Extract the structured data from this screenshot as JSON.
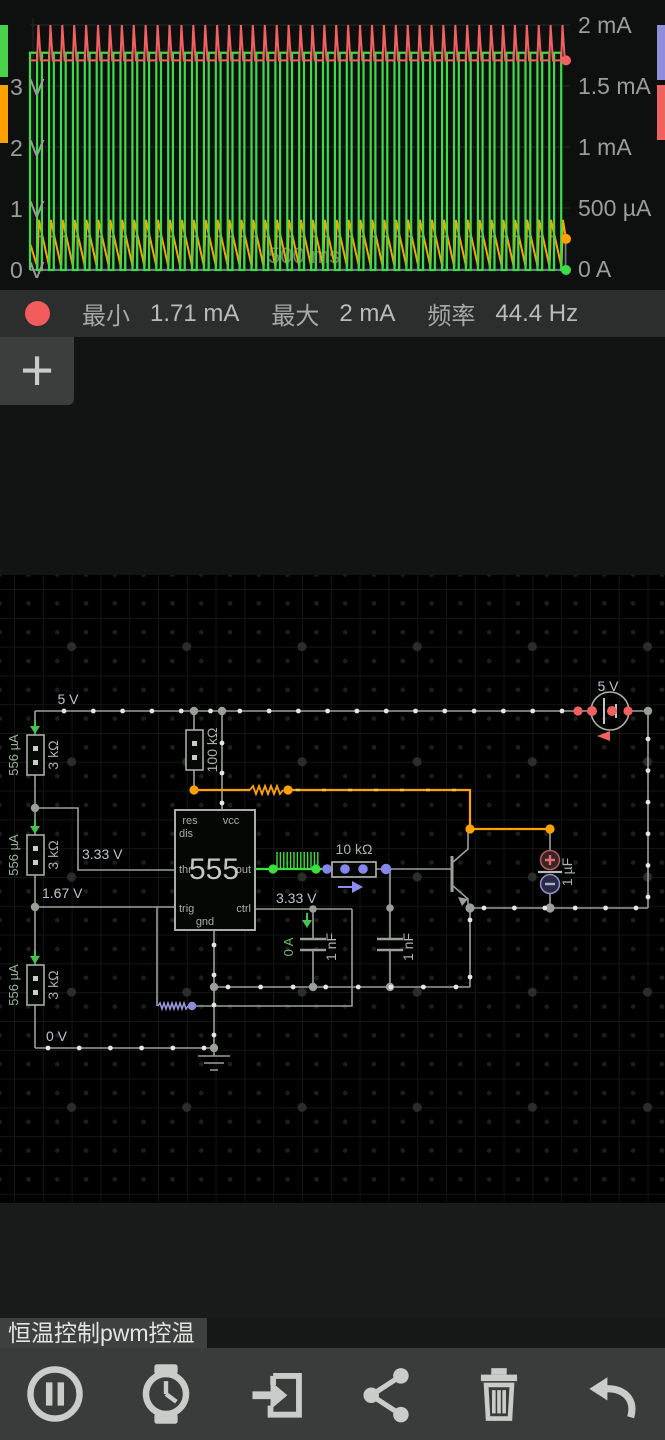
{
  "scope": {
    "left_ticks": [
      "3 V",
      "2 V",
      "1 V",
      "0 V"
    ],
    "right_ticks": [
      "2 mA",
      "1.5 mA",
      "1 mA",
      "500 µA",
      "0 A"
    ],
    "time_label": "500 ms",
    "tabs_left": [
      {
        "name": "channel-green",
        "color": "#4ad34a"
      },
      {
        "name": "channel-orange",
        "color": "#ffa200"
      }
    ],
    "tabs_right": [
      {
        "name": "channel-blue",
        "color": "#8d8dd8"
      },
      {
        "name": "channel-red",
        "color": "#f06262"
      }
    ]
  },
  "chart_data": {
    "type": "line",
    "title": "oscilloscope traces",
    "time_scale": "500 ms",
    "y_axis_left": {
      "unit": "V",
      "ticks": [
        "3 V",
        "2 V",
        "1 V",
        "0 V"
      ],
      "min": 0,
      "max": 4.2
    },
    "y_axis_right": {
      "unit": "A",
      "ticks": [
        "2 mA",
        "1.5 mA",
        "1 mA",
        "500 µA",
        "0 A"
      ],
      "min": 0,
      "max": 0.002
    },
    "cycles": 45,
    "series": [
      {
        "name": "output-voltage",
        "color": "#3bdc46",
        "shape": "square",
        "high_V": 3.55,
        "low_V": 0,
        "duty": 0.6
      },
      {
        "name": "supply-current",
        "color": "#f26060",
        "shape": "spike",
        "base_mA": 1.71,
        "peak_mA": 2.0
      },
      {
        "name": "capacitor-voltage",
        "color": "#ffa200",
        "shape": "sawtooth",
        "min_V": 0.05,
        "max_V": 0.82
      },
      {
        "name": "base-voltage",
        "color": "#8b98a6",
        "shape": "square",
        "high_V": 0.55,
        "low_V": 0,
        "duty": 0.36
      }
    ],
    "measurements": {
      "min": "1.71 mA",
      "max": "2 mA",
      "frequency": "44.4 Hz"
    }
  },
  "stats": {
    "marker_color": "#f25c5c",
    "min_label": "最小",
    "min_value": "1.71 mA",
    "max_label": "最大",
    "max_value": "2 mA",
    "freq_label": "频率",
    "freq_value": "44.4 Hz"
  },
  "add_button": {
    "label": "+"
  },
  "circuit": {
    "labels": {
      "supply_top": "5 V",
      "supply_src": "5 V",
      "r1_i": "556 µA",
      "r1_v": "3 kΩ",
      "r2_i": "556 µA",
      "r2_v": "3 kΩ",
      "r3_i": "556 µA",
      "r3_v": "3 kΩ",
      "r4_v": "100 kΩ",
      "r5_v": "10 kΩ",
      "node_333a": "3.33 V",
      "node_167": "1.67 V",
      "node_0": "0 V",
      "node_333b": "3.33 V",
      "cap1_i": "0 A",
      "cap1_v": "1 nF",
      "cap2_v": "1 nF",
      "cap3_v": "1 µF",
      "ic": "555",
      "pin_res": "res",
      "pin_vcc": "vcc",
      "pin_dis": "dis",
      "pin_thr": "thr",
      "pin_trig": "trig",
      "pin_out": "out",
      "pin_ctrl": "ctrl",
      "pin_gnd": "gnd"
    }
  },
  "footer": {
    "title": "恒温控制pwm控温"
  },
  "toolbar": {
    "items": [
      {
        "name": "pause"
      },
      {
        "name": "history"
      },
      {
        "name": "import"
      },
      {
        "name": "share"
      },
      {
        "name": "delete"
      },
      {
        "name": "undo"
      }
    ]
  }
}
